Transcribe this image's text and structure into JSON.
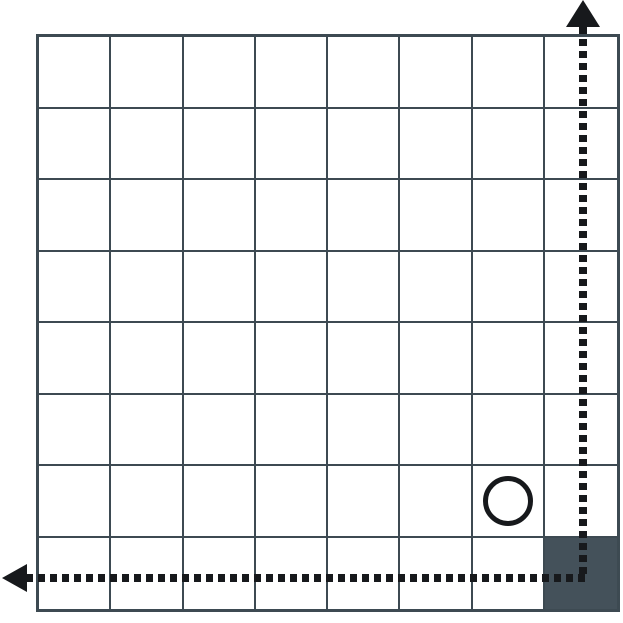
{
  "figure": {
    "type": "grid-diagram",
    "grid": {
      "rows": 8,
      "cols": 8
    },
    "filled_cell": {
      "row": 8,
      "col": 8
    },
    "circle_marker": {
      "row": 7,
      "col": 7
    },
    "arrows": [
      {
        "direction": "up",
        "style": "dotted",
        "origin_cell": {
          "row": 8,
          "col": 8
        }
      },
      {
        "direction": "left",
        "style": "dotted",
        "origin_cell": {
          "row": 8,
          "col": 8
        }
      }
    ],
    "colors": {
      "background": "#ffffff",
      "grid_line": "#3d4a52",
      "filled_cell": "#44515a",
      "arrow": "#17191c",
      "circle": "#17191c"
    }
  }
}
